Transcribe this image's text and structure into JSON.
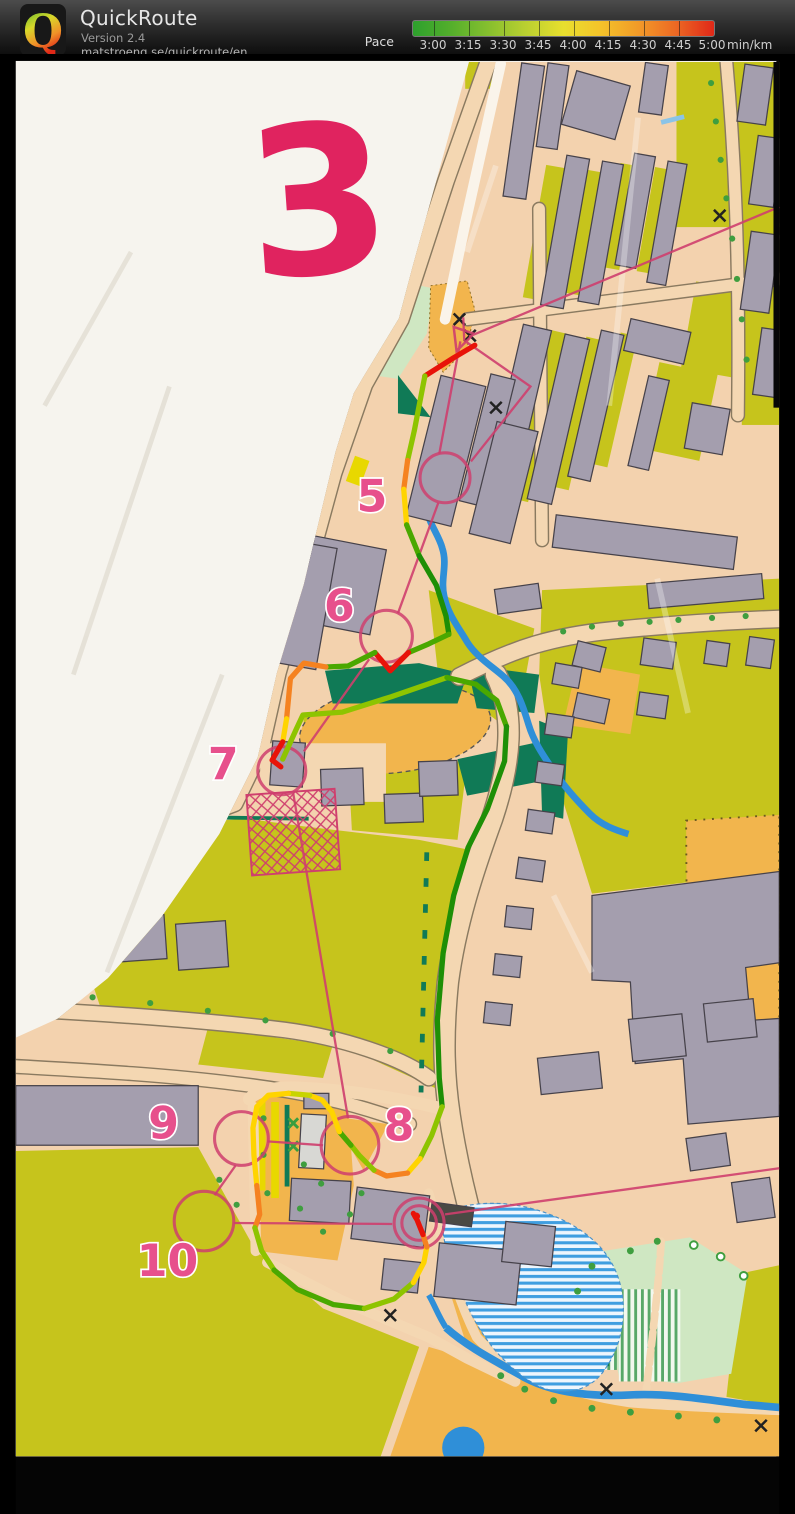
{
  "header": {
    "app_name": "QuickRoute",
    "version": "Version 2.4",
    "url": "matstroeng.se/quickroute/en",
    "logo_letter": "Q",
    "pace_label": "Pace",
    "unit": "min/km",
    "scale_ticks": [
      "3:00",
      "3:15",
      "3:30",
      "3:45",
      "4:00",
      "4:15",
      "4:30",
      "4:45",
      "5:00"
    ]
  },
  "map": {
    "page_number": "3",
    "controls": [
      "5",
      "6",
      "7",
      "8",
      "9",
      "10"
    ],
    "course_color": "#cf3f6e",
    "paper_color": "#f6f4ee",
    "pace_colors": {
      "fast": "#1e8f06",
      "medium_fast": "#8ec400",
      "medium": "#ffd400",
      "slow": "#f58220",
      "very_slow": "#e81309"
    }
  }
}
